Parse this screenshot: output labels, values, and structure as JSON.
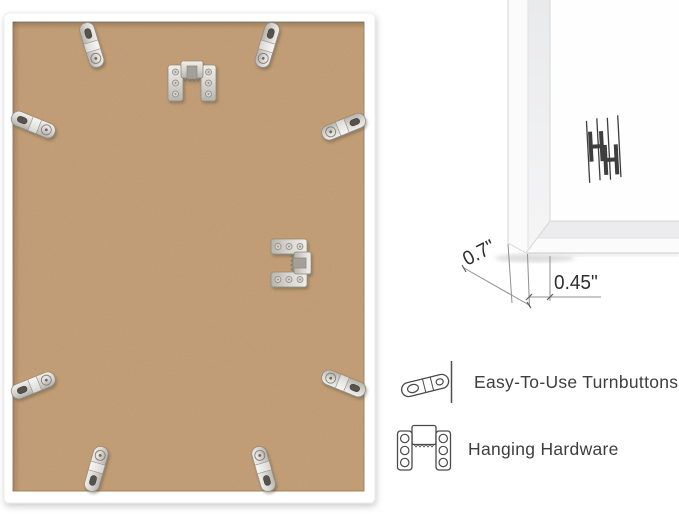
{
  "scene": {
    "background_color": "#ffffff",
    "back_view": {
      "board_color": "#c7a179",
      "frame_color": "#ffffff",
      "turnbutton_count": 8,
      "sawtooth_hanger_count": 2
    },
    "profile_view": {
      "logo_text": "HH",
      "measurements": {
        "depth": "0.7\"",
        "face": "0.45\""
      }
    },
    "features": [
      {
        "icon": "turnbutton-icon",
        "label": "Easy-To-Use Turnbuttons"
      },
      {
        "icon": "hanging-hardware-icon",
        "label": "Hanging Hardware"
      }
    ],
    "colors": {
      "line_art": "#4a4a4a",
      "label_text": "#3e3e3e",
      "dimension_text": "#2e2e2e",
      "metal_light": "#efede9",
      "metal_dark": "#c9c6c0"
    }
  }
}
